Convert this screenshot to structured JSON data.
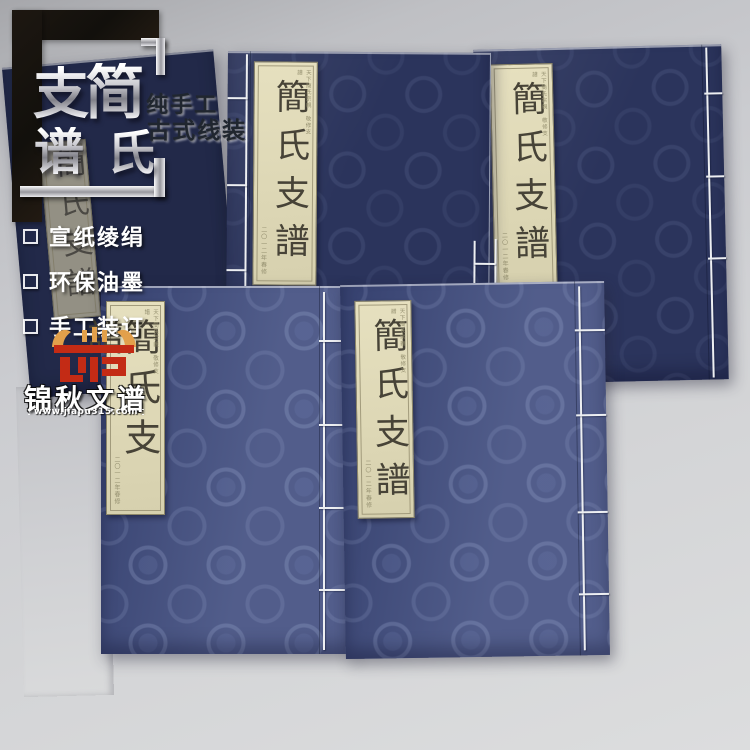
{
  "promo": {
    "big_chars": [
      "支",
      "谱",
      "简",
      "氏"
    ],
    "subtitle_line1": "纯手工",
    "subtitle_line2": "古式线装",
    "features": [
      {
        "label": "宣纸绫绢"
      },
      {
        "label": "环保油墨"
      },
      {
        "label": "手工装订"
      }
    ]
  },
  "brand": {
    "name": "锦秋文谱",
    "website": "www.jiapu315.com",
    "seal_red": "#c32b15",
    "seal_orange": "#e2a04b"
  },
  "books": [
    {
      "position": "top-left",
      "title": "簡氏支譜",
      "note_top": "",
      "note_bottom": ""
    },
    {
      "position": "top-center",
      "title": "簡氏支譜",
      "note_top": "天下簡氏宗親 敬修支譜",
      "note_bottom": "二〇一二年春修"
    },
    {
      "position": "top-right",
      "title": "簡氏支譜",
      "note_top": "天下簡氏宗親 敬修支譜",
      "note_bottom": "二〇一二年春修"
    },
    {
      "position": "bottom-left",
      "title": "簡氏支譜",
      "note_top": "天下簡氏宗親 敬修支譜",
      "note_bottom": "二〇一二年春修"
    },
    {
      "position": "bottom-right",
      "title": "簡氏支譜",
      "note_top": "天下簡氏宗親 敬修支譜",
      "note_bottom": "二〇一二年春修"
    }
  ],
  "colors": {
    "cover_navy_dark": "#2b345c",
    "cover_navy_bright": "#3e4b7e",
    "label_cream": "#e0dab9",
    "thread_white": "#edeff2",
    "background_gray": "#cfd0d3"
  }
}
